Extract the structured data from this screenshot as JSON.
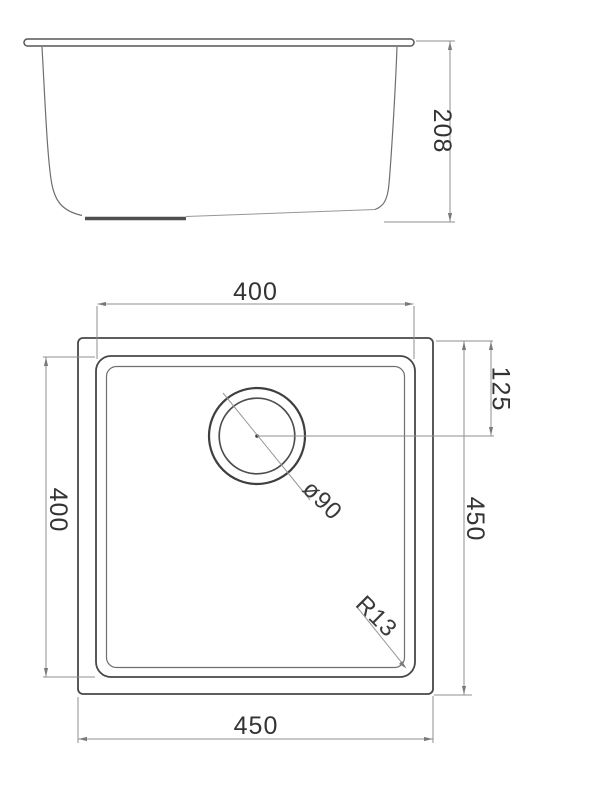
{
  "side_view": {
    "height_label": "208"
  },
  "plan_view": {
    "inner_width_top_label": "400",
    "inner_height_left_label": "400",
    "outer_height_right_label": "450",
    "drain_offset_label": "125",
    "outer_width_bottom_label": "450",
    "drain_diameter_label": "ø90",
    "corner_radius_label": "R13"
  },
  "colors": {
    "background": "#ffffff",
    "outline_dark": "#474747",
    "outline_light": "#6f6f6f",
    "dimension_line": "#8f8f8f",
    "text": "#333333"
  }
}
